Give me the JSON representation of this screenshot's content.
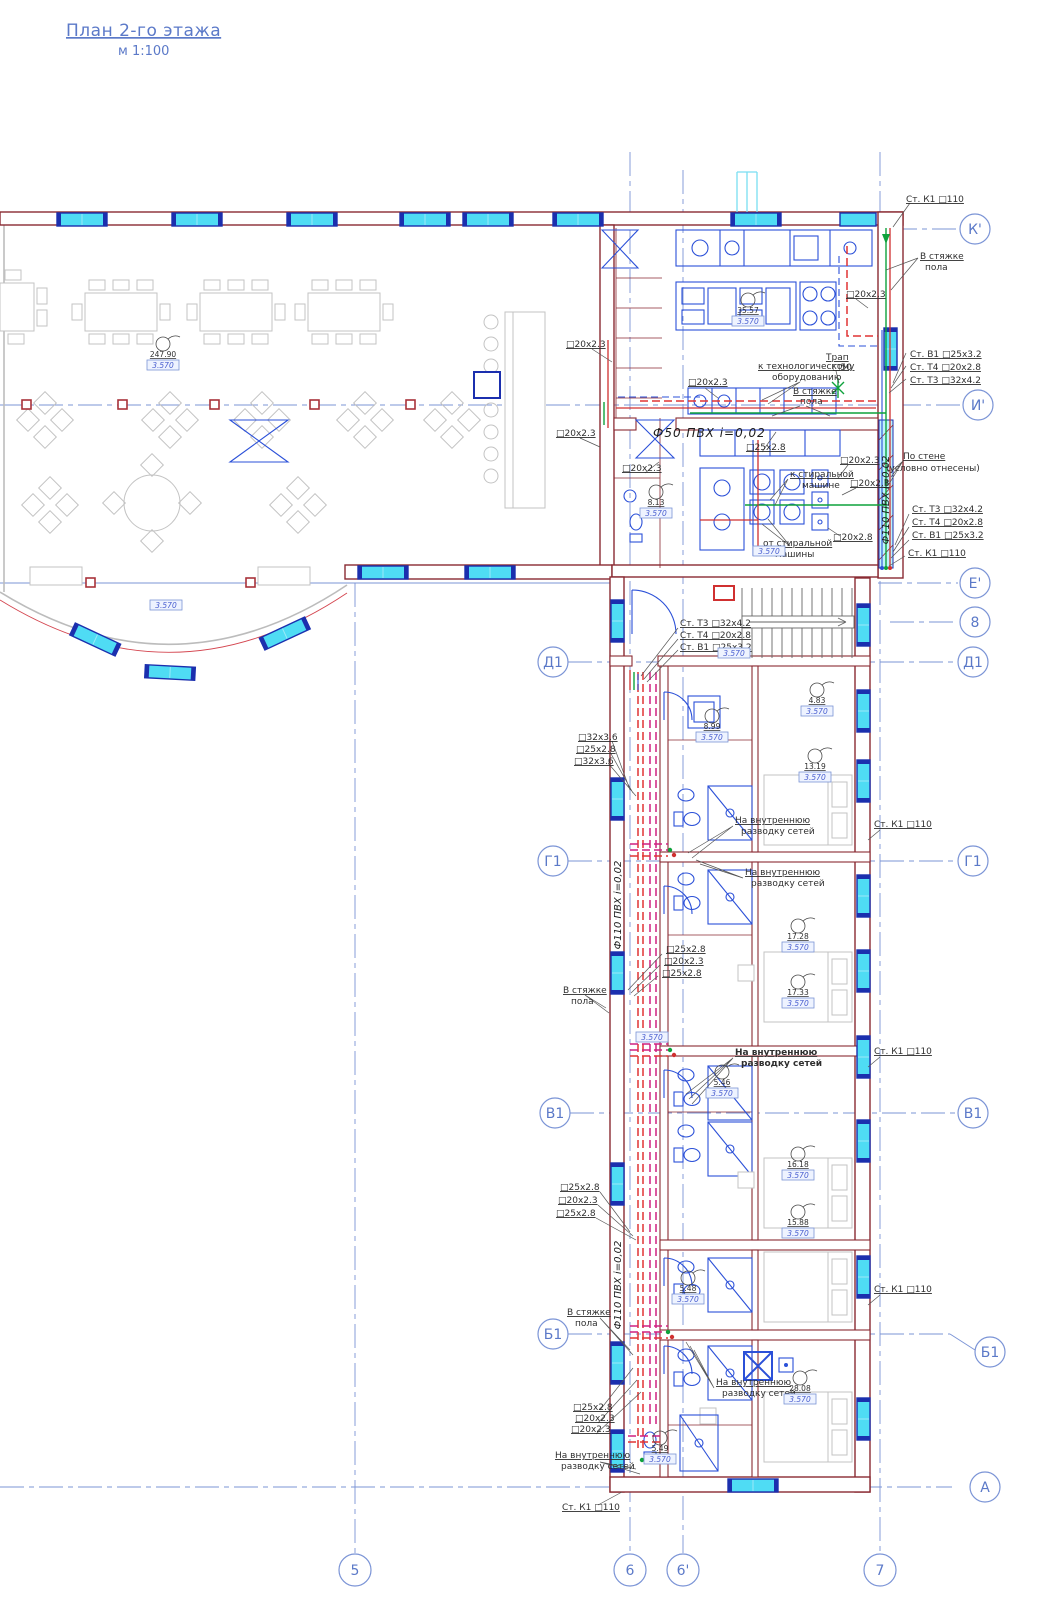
{
  "title": {
    "main": "План 2-го этажа",
    "scale": "м 1:100"
  },
  "axes": {
    "horizontal": {
      "kp": "К'",
      "ip": "И'",
      "ep": "Е'",
      "n8": "8",
      "d1": "Д1",
      "g1": "Г1",
      "v1": "В1",
      "b1": "Б1",
      "a": "А"
    },
    "vertical": {
      "n5": "5",
      "n6": "6",
      "n6p": "6'",
      "n7": "7"
    }
  },
  "labels": {
    "st_k1": "Ст. К1  □110",
    "st_v1": "Ст. В1  □25x3.2",
    "st_t4": "Ст. Т4  □20x2.8",
    "st_t3": "Ст. Т3  □32x4.2",
    "p20": "□20x2.3",
    "p25": "□25x2.8",
    "p28": "□20x2.8",
    "p32": "□32x3.6",
    "trap1": "Трап",
    "trap2": "□50",
    "f50": "Ф50 ПВХ    i=0,02",
    "f110": "Ф110 ПВХ  i=0,02",
    "po1": "По стене",
    "po2": "(условно отнесены)",
    "ktech1": "к технологическому",
    "ktech2": "оборудованию",
    "vst1": "В стяжке",
    "vst2": "пола",
    "kst1": "к стиральной",
    "kst2": "машине",
    "ots1": "от стиральной",
    "ots2": "машины",
    "nav1": "На внутреннюю",
    "nav2": "разводку сетей"
  },
  "rooms": [
    "247.90",
    "35.57",
    "8.13",
    "8.99",
    "4.83",
    "13.19",
    "17.28",
    "17.33",
    "5.46",
    "16.18",
    "15.88",
    "5.48",
    "28.08",
    "5.49"
  ],
  "elev": "3.570",
  "colors": {
    "axis_blue": "#7b94d6",
    "wall_maroon": "#8a2a32",
    "pipe_hot_red": "#e03434",
    "pipe_magenta": "#cf2080",
    "fixture_blue": "#2b50d8",
    "window_cyan": "#4fdcf4",
    "window_frame": "#1b2fae",
    "pipe_green": "#0ea23c",
    "furniture_gray": "#c3c3c3",
    "text_dark": "#2f2f2f",
    "elevation_blue": "#4a5fd0"
  }
}
